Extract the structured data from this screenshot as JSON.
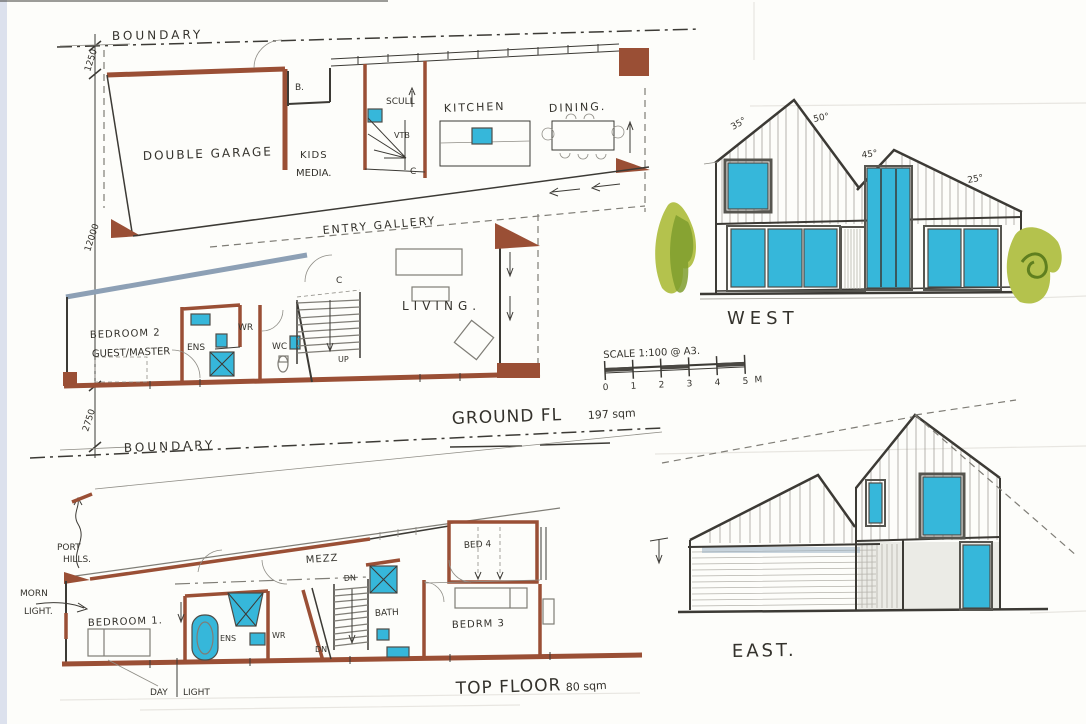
{
  "page": {
    "sheet_bg": "#fdfdfa"
  },
  "colors": {
    "wall_brown": "#9a4f35",
    "steel_blue": "#8da0b5",
    "glass_cyan": "#36b7da",
    "tree_light": "#b4c24d",
    "tree_dark": "#7f9d2e",
    "ink": "#3c3a35"
  },
  "ground_floor_plan": {
    "boundary_label": "BOUNDARY",
    "dimensions": {
      "setback_top": "1250",
      "depth": "12000",
      "setback_bottom": "2750"
    },
    "rooms": {
      "garage": "DOUBLE GARAGE",
      "kids_line1": "KIDS",
      "kids_line2": "MEDIA.",
      "b_store": "B.",
      "scullery": "SCULL",
      "vestibule": "VTB",
      "pantry_c": "C",
      "kitchen": "KITCHEN",
      "dining": "DINING.",
      "entry_gallery": "ENTRY GALLERY",
      "living": "LIVING.",
      "bedroom2_line1": "BEDROOM 2",
      "bedroom2_line2": "GUEST/MASTER",
      "ensuite": "ENS",
      "wardrobe": "WR",
      "wc": "WC",
      "stair_c": "C",
      "stair_up": "UP"
    },
    "caption": "GROUND FL",
    "caption_area": "197 sqm"
  },
  "top_floor_plan": {
    "boundary_label": "BOUNDARY",
    "annotations": {
      "port": "PORT",
      "hills": "HILLS.",
      "morn": "MORN",
      "morn_light": "LIGHT.",
      "day": "DAY",
      "day_light": "LIGHT"
    },
    "rooms": {
      "bedroom1": "BEDROOM 1.",
      "ensuite": "ENS",
      "wardrobe": "WR",
      "mezz": "MEZZ",
      "dn_upper": "DN",
      "dn_lower": "DN",
      "bath": "BATH",
      "bedrm3": "BEDRM 3",
      "bed4": "BED 4"
    },
    "caption": "TOP FLOOR",
    "caption_area": "80 sqm"
  },
  "west_elevation": {
    "label": "WEST",
    "angles": {
      "left": "35°",
      "main": "50°",
      "mid": "45°",
      "right": "25°"
    }
  },
  "east_elevation": {
    "label": "EAST."
  },
  "scale_bar": {
    "label": "SCALE 1:100 @ A3.",
    "ticks": [
      "0",
      "1",
      "2",
      "3",
      "4",
      "5"
    ],
    "unit": "M"
  }
}
